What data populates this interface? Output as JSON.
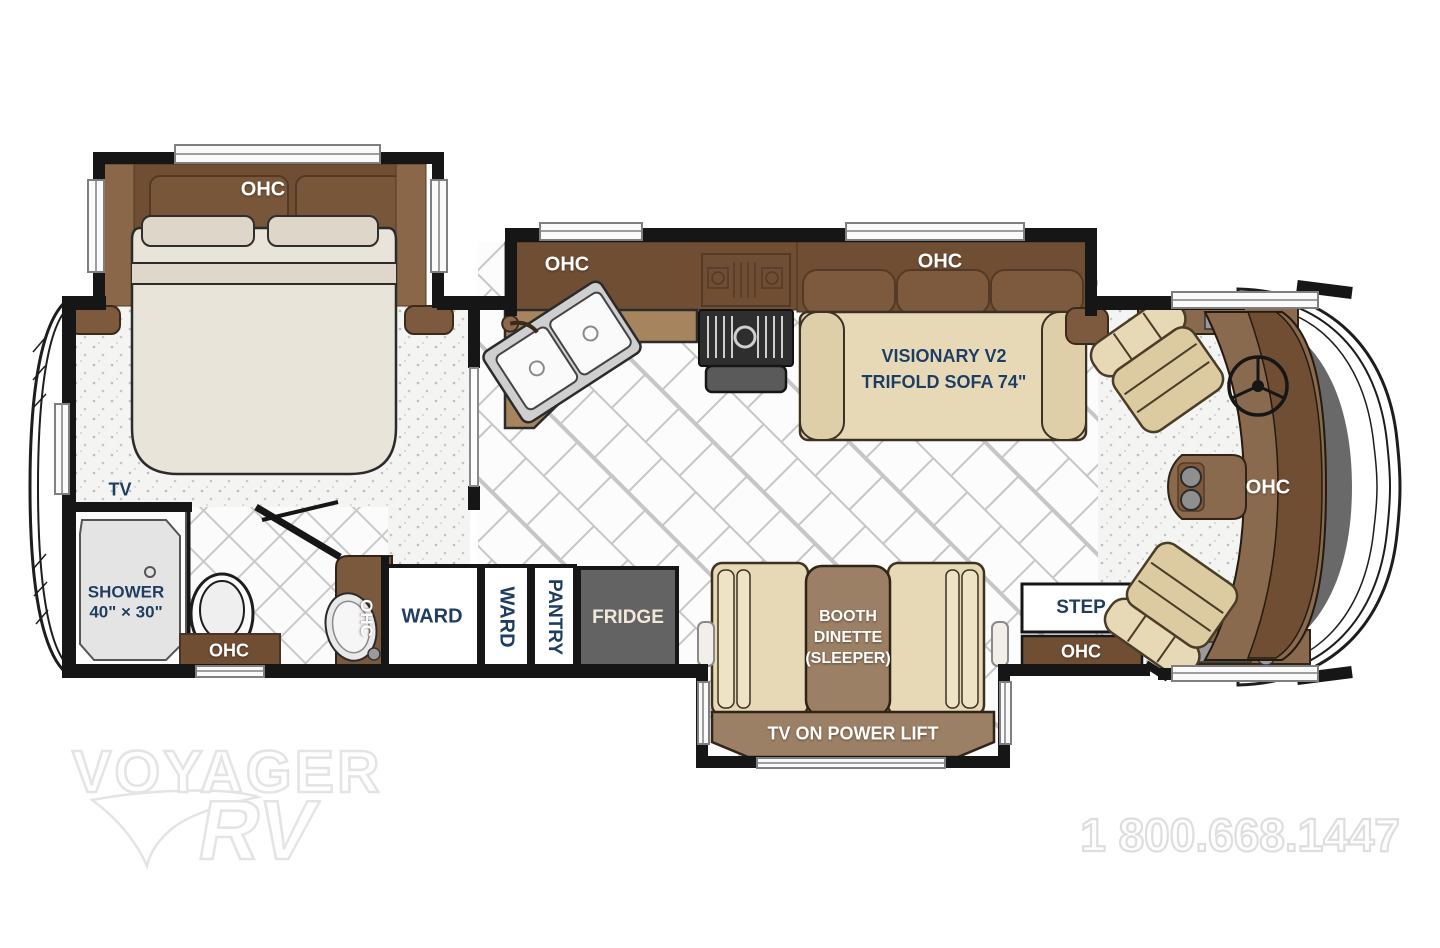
{
  "floorplan": {
    "bedroom": {
      "ohc": "OHC",
      "tv": "TV"
    },
    "bathroom": {
      "shower_line1": "SHOWER",
      "shower_line2": "40\" × 30\"",
      "ohc": "OHC",
      "vanity_ohc": "OHC"
    },
    "storage": {
      "ward_large": "WARD",
      "ward_small": "WARD",
      "pantry": "PANTRY",
      "fridge": "FRIDGE"
    },
    "kitchen": {
      "ohc": "OHC"
    },
    "living": {
      "sofa_ohc": "OHC",
      "sofa_line1": "VISIONARY V2",
      "sofa_line2": "TRIFOLD SOFA 74\"",
      "dinette_line1": "BOOTH",
      "dinette_line2": "DINETTE",
      "dinette_line3": "(SLEEPER)",
      "tv_lift": "TV ON POWER LIFT"
    },
    "entry": {
      "step": "STEP",
      "ohc": "OHC"
    },
    "cockpit": {
      "ohc": "OHC"
    }
  },
  "watermark": {
    "brand_top": "VOYAGER",
    "brand_bottom": "RV",
    "phone": "1 800.668.1447"
  },
  "colors": {
    "wall": "#161616",
    "cabinet_dark": "#6f4e34",
    "cabinet_mid": "#7d5a3e",
    "counter": "#a5845e",
    "upholstery_tan": "#e7d8b6",
    "table_brown": "#9c8066",
    "fridge_gray": "#636363",
    "label_navy": "#1f3d5f",
    "label_white": "#ffffff",
    "watermark_gray": "#e4e4e4"
  }
}
